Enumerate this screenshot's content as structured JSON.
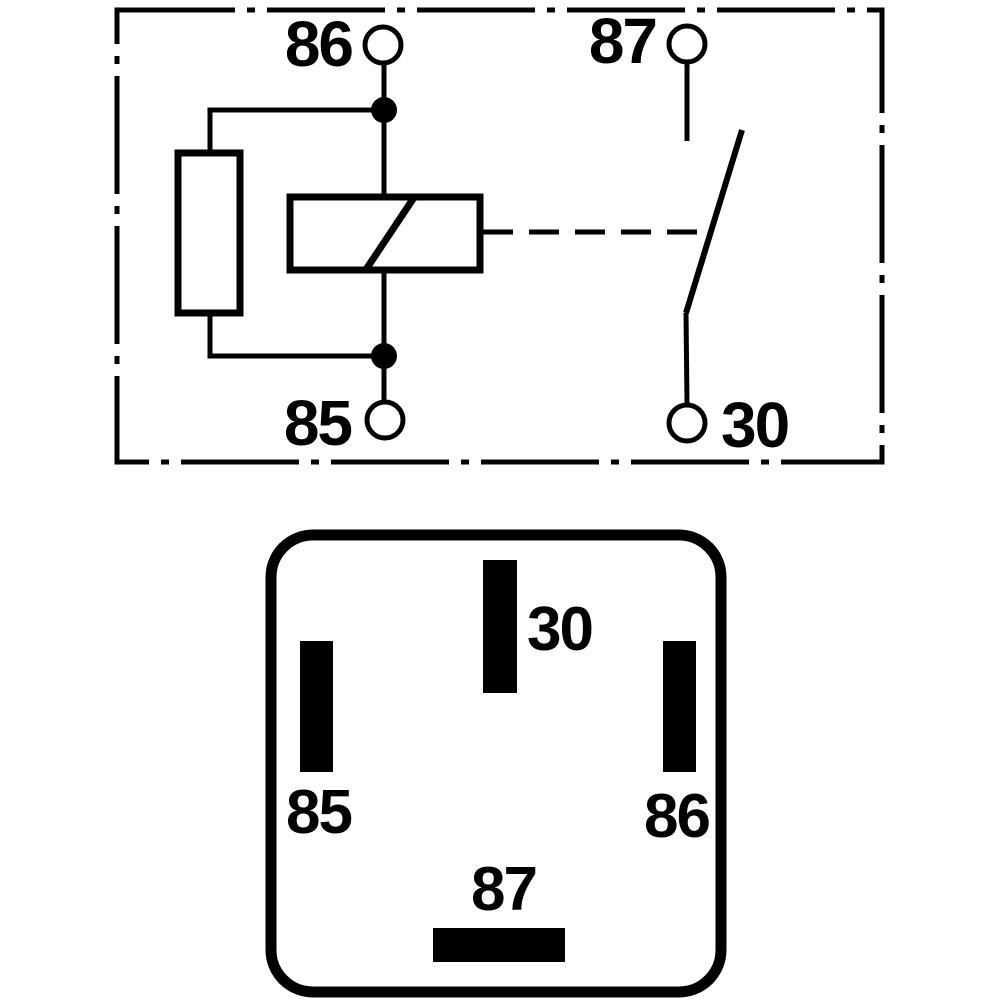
{
  "figure": {
    "type": "relay-wiring-diagram",
    "background_color": "#ffffff",
    "line_color": "#000000"
  },
  "schematic": {
    "description": "relay internal circuit inside dash-dot boundary frame",
    "components": [
      "coil-symbol",
      "parallel-resistor-symbol",
      "normally-open-switch-symbol",
      "dashed-actuator-link"
    ],
    "labels": {
      "terminal_top_left": "86",
      "terminal_top_right": "87",
      "terminal_bottom_left": "85",
      "terminal_bottom_right": "30"
    }
  },
  "connector": {
    "description": "relay socket pin footprint, rounded square outline",
    "labels": {
      "pin_top_center": "30",
      "pin_left": "85",
      "pin_right": "86",
      "pin_bottom_center": "87"
    }
  }
}
